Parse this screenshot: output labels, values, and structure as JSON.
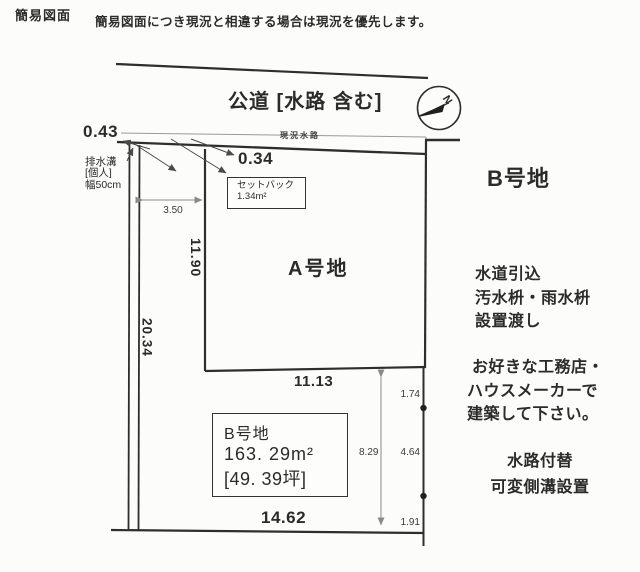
{
  "header": {
    "title": "簡易図面",
    "disclaimer": "簡易図面につき現況と相違する場合は現況を優先します。"
  },
  "road": {
    "label": "公道 [水路 含む]",
    "waterway_label": "現況水路"
  },
  "compass": {
    "north_label": "N"
  },
  "annotations": {
    "offset_left": "0.43",
    "offset_right": "0.34",
    "drain": {
      "line1": "排水溝",
      "line2": "[個人]",
      "line3": "幅50cm"
    },
    "setback": {
      "line1": "セットバック",
      "line2": "1.34m²"
    }
  },
  "dimensions": {
    "setback_width": "3.50",
    "a_left": "11.90",
    "b_left_total": "20.34",
    "a_bottom": "11.13",
    "b_right_total": "8.29",
    "b_right_seg1": "1.74",
    "b_right_seg2": "4.64",
    "b_right_seg3": "1.91",
    "b_bottom": "14.62"
  },
  "plots": {
    "a_label": "A号地",
    "b_title": "B号地",
    "b_info": {
      "name": "B号地",
      "area_m2": "163. 29m²",
      "area_tsubo": "[49. 39坪]"
    }
  },
  "notes": {
    "utilities": [
      "水道引込",
      "汚水枡・雨水枡",
      "設置渡し"
    ],
    "build": [
      "お好きな工務店・",
      "ハウスメーカーで",
      "建築して下さい。"
    ],
    "waterway": [
      "水路付替",
      "可変側溝設置"
    ]
  },
  "colors": {
    "ink": "#2b2b2b",
    "line": "#2e2e2e",
    "dim": "#8a8a8a"
  }
}
